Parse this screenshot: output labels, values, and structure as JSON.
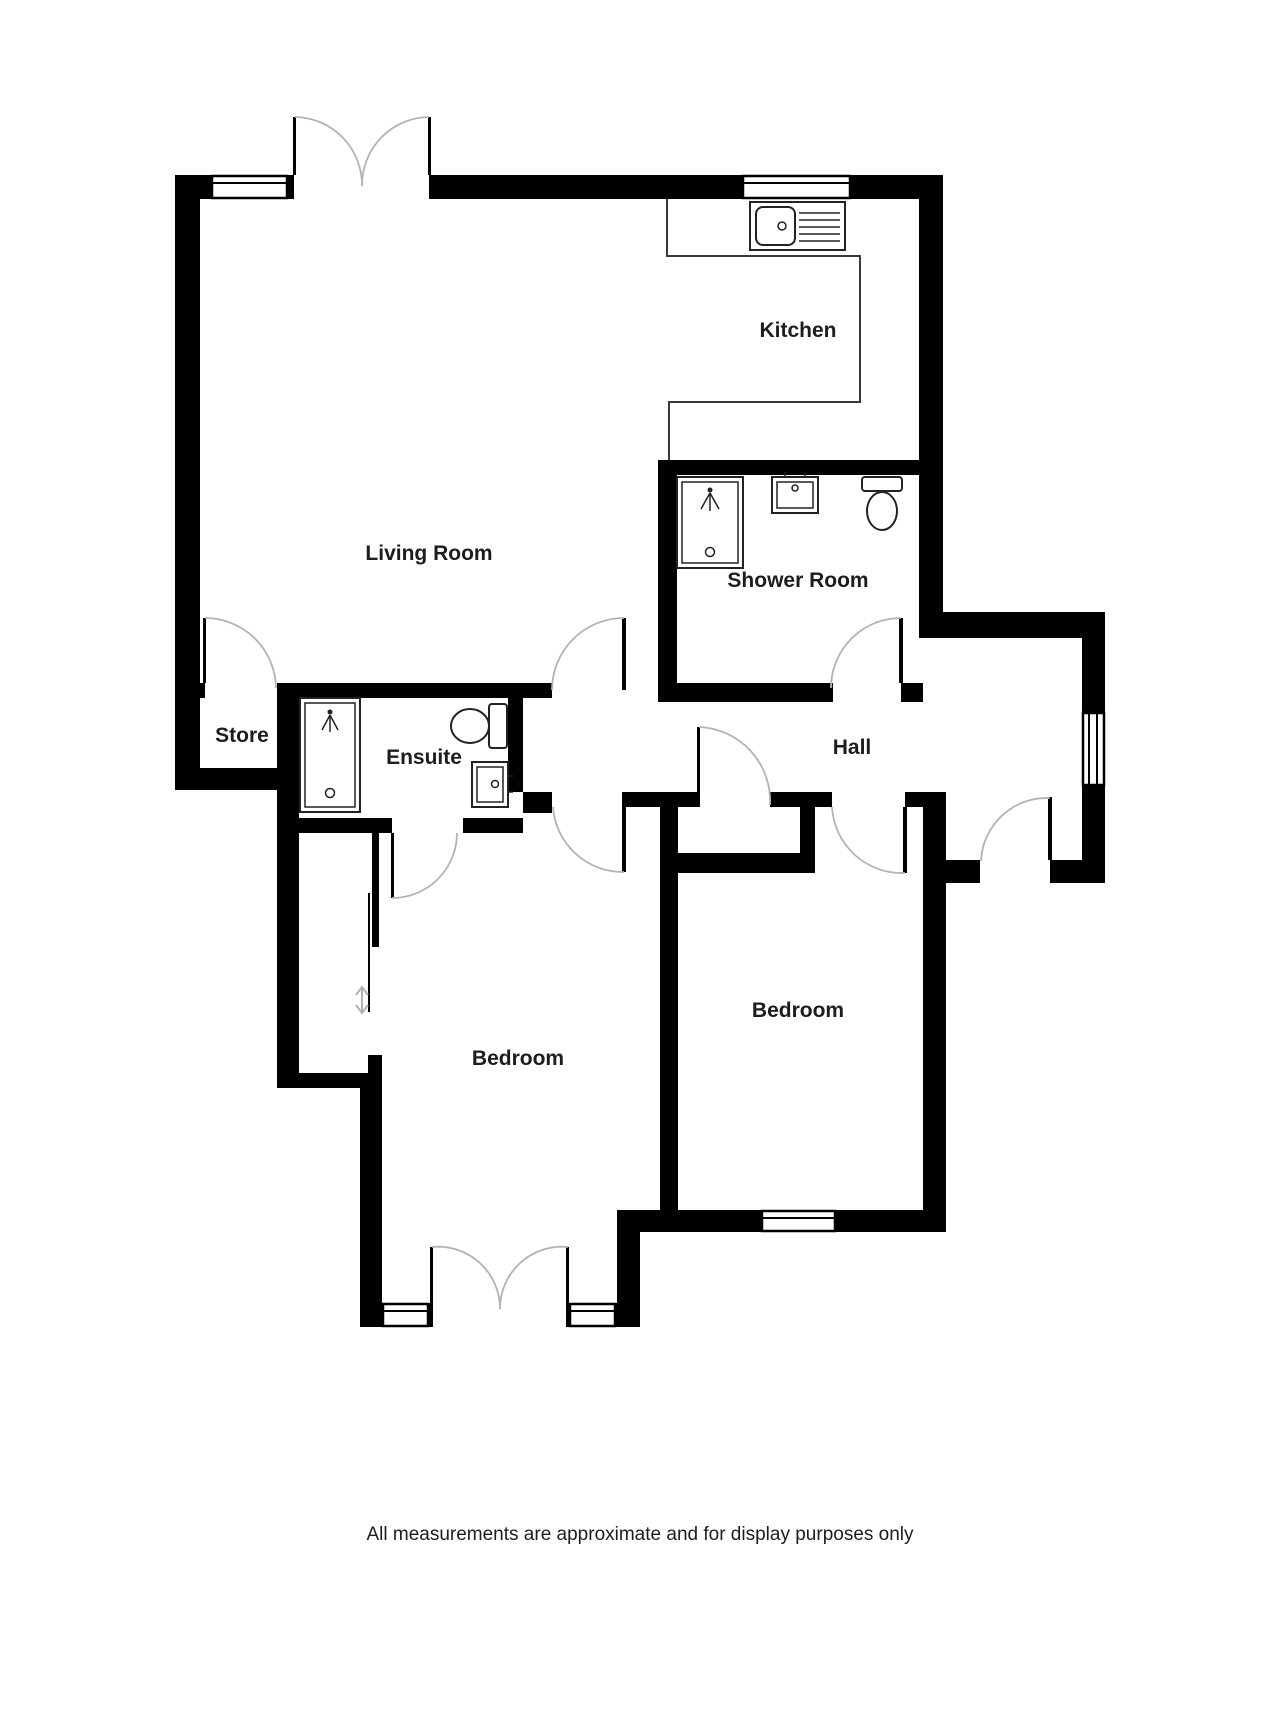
{
  "labels": {
    "living_room": "Living Room",
    "kitchen": "Kitchen",
    "shower_room": "Shower Room",
    "store": "Store",
    "ensuite": "Ensuite",
    "hall": "Hall",
    "bedroom_left": "Bedroom",
    "bedroom_right": "Bedroom",
    "caption": "All measurements are approximate and for display purposes only"
  },
  "colors": {
    "wall": "#000000",
    "line": "#3a3a3a",
    "door_arc": "#b3b3b3",
    "fixture_line": "#222222",
    "text": "#1d1d1d",
    "background": "#ffffff"
  }
}
